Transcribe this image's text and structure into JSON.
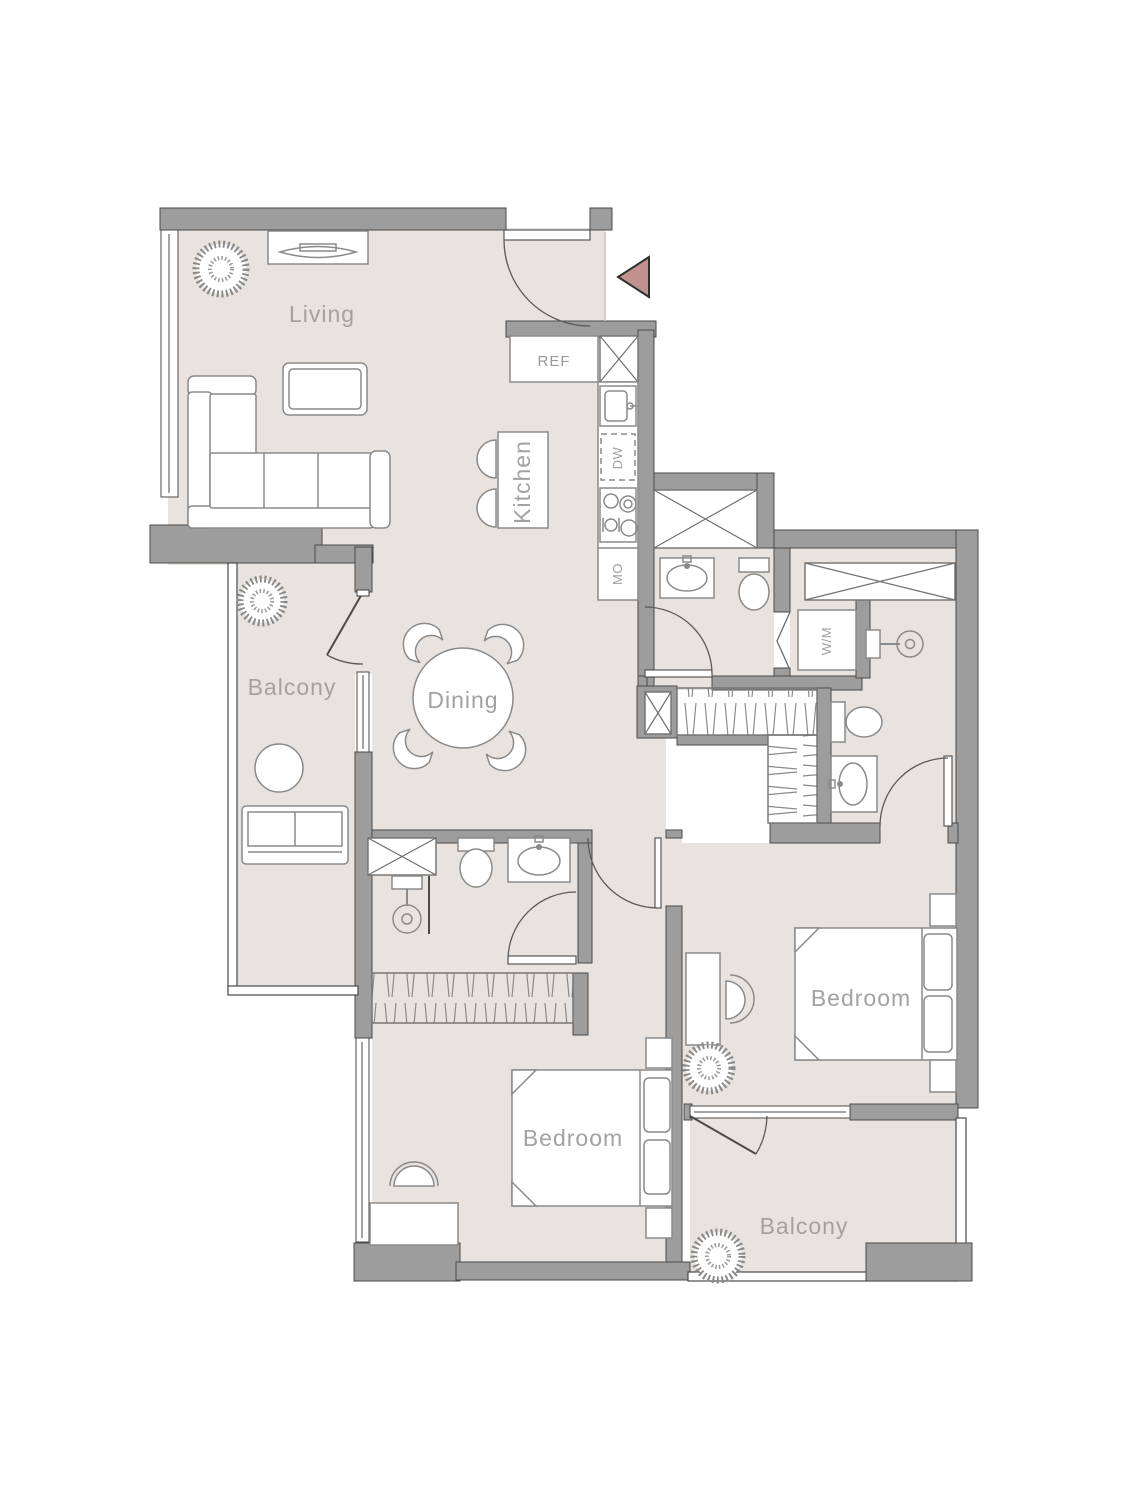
{
  "floorplan": {
    "rooms": {
      "living": "Living",
      "kitchen": "Kitchen",
      "dining": "Dining",
      "balcony_left": "Balcony",
      "balcony_bottom": "Balcony",
      "bedroom_left": "Bedroom",
      "bedroom_right": "Bedroom"
    },
    "appliances": {
      "refrigerator": "REF",
      "dishwasher": "DW",
      "microwave": "MO",
      "washing_machine": "W/M"
    },
    "colors": {
      "floor": "#e8e3de",
      "wall": "#9d9d9d",
      "wall_outline": "#4a4a4a",
      "fixture_line": "#8a8a8a",
      "label_text": "#a5a1a0",
      "entry_arrow": "#c0928e"
    }
  }
}
